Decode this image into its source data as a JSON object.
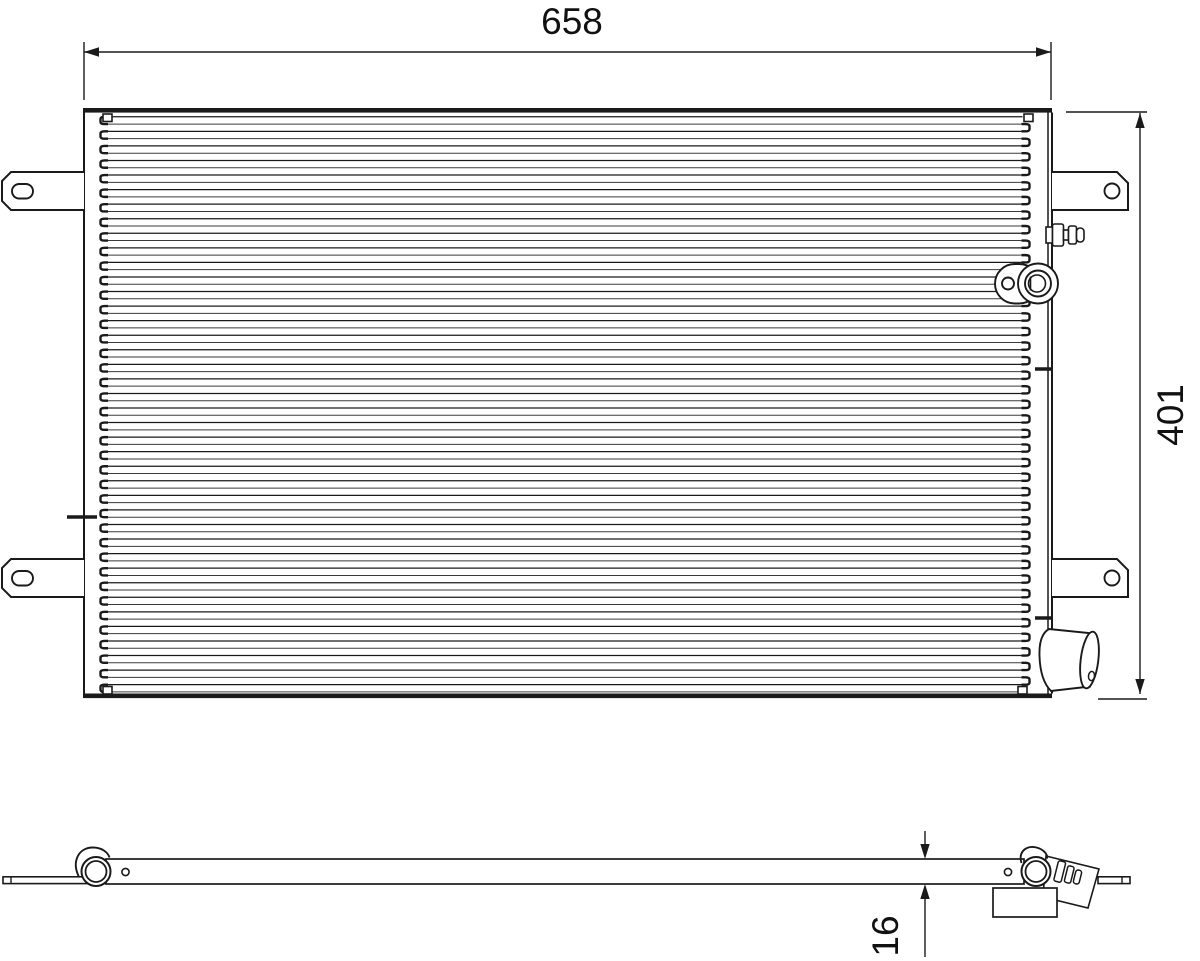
{
  "drawing": {
    "type": "technical-drawing-condenser",
    "colors": {
      "line": "#1a1a1a",
      "fin_line": "#3a3a3a",
      "background": "#ffffff"
    },
    "dimensions": {
      "width": "658",
      "height": "401",
      "thickness": "16"
    }
  }
}
